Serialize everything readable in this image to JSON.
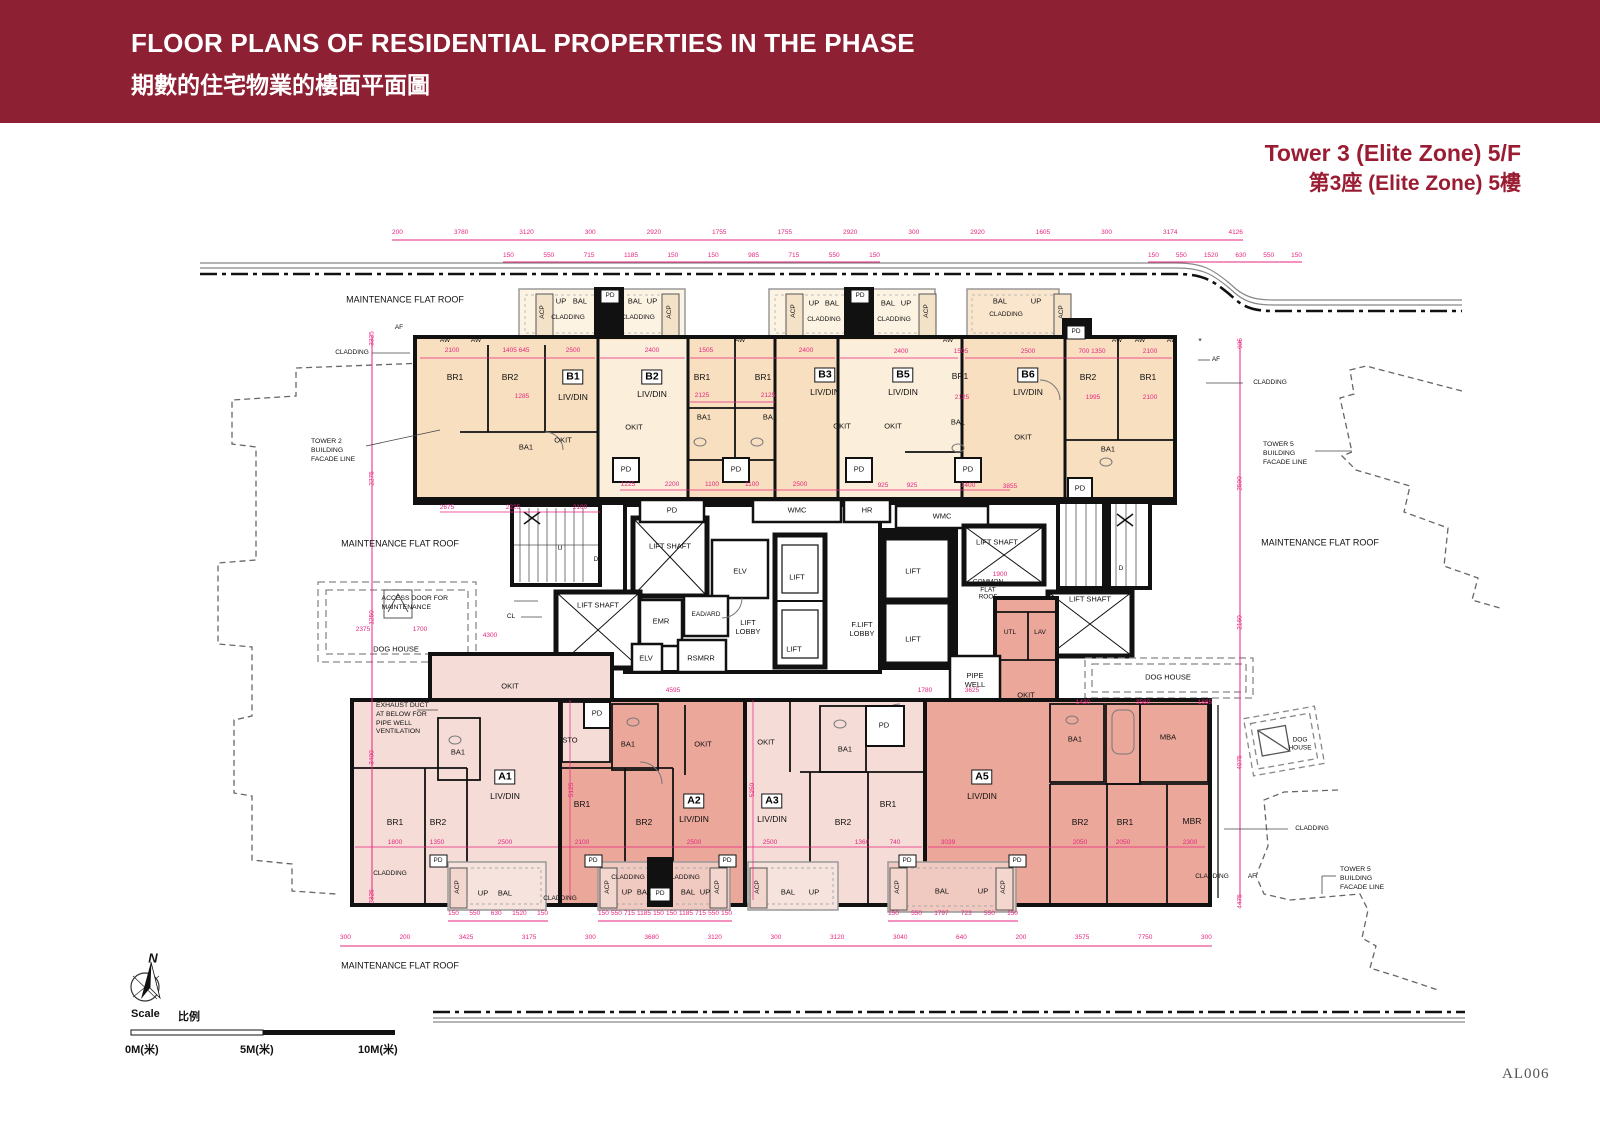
{
  "header": {
    "title_en": "FLOOR PLANS OF RESIDENTIAL PROPERTIES IN THE PHASE",
    "title_zh": "期數的住宅物業的樓面平面圖"
  },
  "plan_title": {
    "en": "Tower 3 (Elite Zone) 5/F",
    "zh": "第3座 (Elite Zone) 5樓"
  },
  "footer": {
    "sheet_no": "AL006"
  },
  "compass": {
    "label": "N"
  },
  "scale_bar": {
    "label_en": "Scale",
    "label_zh": "比例",
    "tick_0": "0M(米)",
    "tick_5": "5M(米)",
    "tick_10": "10M(米)"
  },
  "units": {
    "b1": "B1",
    "b2": "B2",
    "b3": "B3",
    "b5": "B5",
    "b6": "B6",
    "a1": "A1",
    "a2": "A2",
    "a3": "A3",
    "a5": "A5"
  },
  "labels": {
    "br1": "BR1",
    "br2": "BR2",
    "ba1": "BA1",
    "mba": "MBA",
    "mbr": "MBR",
    "livdin": "LIV/DIN",
    "okit": "OKIT",
    "sto": "STO",
    "pd": "PD",
    "bal": "BAL",
    "up": "UP",
    "acp": "ACP",
    "aw": "AW",
    "af": "AF",
    "cl": "CL",
    "u": "U",
    "d": "D",
    "utl": "UTL",
    "lav": "LAV",
    "elv": "ELV",
    "emr": "EMR",
    "rsmrr": "RSMRR",
    "ead_ard": "EAD/ARD",
    "wmc": "WMC",
    "hr": "HR",
    "lift": "LIFT",
    "lift_shaft": "LIFT SHAFT",
    "lift_lobby": "LIFT\nLOBBY",
    "f_lift_lobby": "F.LIFT\nLOBBY",
    "common_flat_roof": "COMMON\nFLAT\nROOF",
    "pipe_well": "PIPE\nWELL",
    "dog_house": "DOG HOUSE",
    "dog_house_2l": "DOG\nHOUSE",
    "maintenance_flat_roof": "MAINTENANCE FLAT ROOF",
    "cladding": "CLADDING",
    "star": "*"
  },
  "annotations": {
    "tower2_facade": "TOWER 2\nBUILDING\nFACADE LINE",
    "tower5_facade": "TOWER 5\nBUILDING\nFACADE LINE",
    "access_door": "ACCESS DOOR FOR\nMAINTENANCE",
    "exhaust_duct": "EXHAUST DUCT\nAT BELOW FOR\nPIPE WELL\nVENTILATION"
  },
  "dims": {
    "chains": {
      "top_main": [
        "200",
        "3780",
        "3120",
        "300",
        "2920",
        "1755",
        "1755",
        "2920",
        "300",
        "2920",
        "1605",
        "300",
        "3174",
        "4126"
      ],
      "top_sub": [
        "150",
        "550",
        "715",
        "1185",
        "150",
        "150",
        "985",
        "715",
        "550",
        "150"
      ],
      "right_sub": [
        "150",
        "550",
        "1520",
        "630",
        "550",
        "150"
      ],
      "bottom_main": [
        "300",
        "200",
        "3425",
        "3175",
        "300",
        "3680",
        "3120",
        "300",
        "3120",
        "3040",
        "640",
        "200",
        "3575",
        "7750",
        "300"
      ],
      "left_v": [
        "3325",
        "2275",
        "1250",
        "3400",
        "3325"
      ],
      "right_v": [
        "935",
        "2590",
        "2160",
        "4075",
        "4475"
      ],
      "bal_a1": [
        "150",
        "550",
        "630",
        "1520",
        "150"
      ],
      "bal_a2": [
        "150",
        "550",
        "715",
        "1185",
        "150",
        "150",
        "1185",
        "715",
        "550",
        "150"
      ],
      "bal_a5": [
        "150",
        "550",
        "1797",
        "723",
        "550",
        "150"
      ]
    },
    "vals": {
      "v2100": "2100",
      "v1405_645": "1405 645",
      "v2500": "2500",
      "v2400": "2400",
      "v1505": "1505",
      "v700_1350": "700 1350",
      "v1285": "1285",
      "v2125": "2125",
      "v1995": "1995",
      "v1225": "1225",
      "v2200": "2200",
      "v1100": "1100",
      "v925": "925",
      "v1400": "1400",
      "v3855": "3855",
      "v2675": "2675",
      "v2225": "2225",
      "v1900": "1900",
      "v2375": "2375",
      "v1700": "1700",
      "v4595": "4595",
      "v1780": "1780",
      "v3625": "3625",
      "v1430": "1430",
      "v3560": "3560",
      "v1685": "1685",
      "v1800": "1800",
      "v1350": "1350",
      "v1360": "1360",
      "v740": "740",
      "v3039": "3039",
      "v2050": "2050",
      "v2300": "2300",
      "v5125": "5125",
      "v5250": "5250",
      "v4300": "4300"
    }
  },
  "colors": {
    "banner": "#8e2034",
    "title": "#9a1c33",
    "dim_pink": "#e7257f",
    "unit_peach": "#f8dfc0",
    "unit_cream": "#fbeeda",
    "unit_pink": "#f5dcd7",
    "unit_salmon": "#eba79a"
  }
}
